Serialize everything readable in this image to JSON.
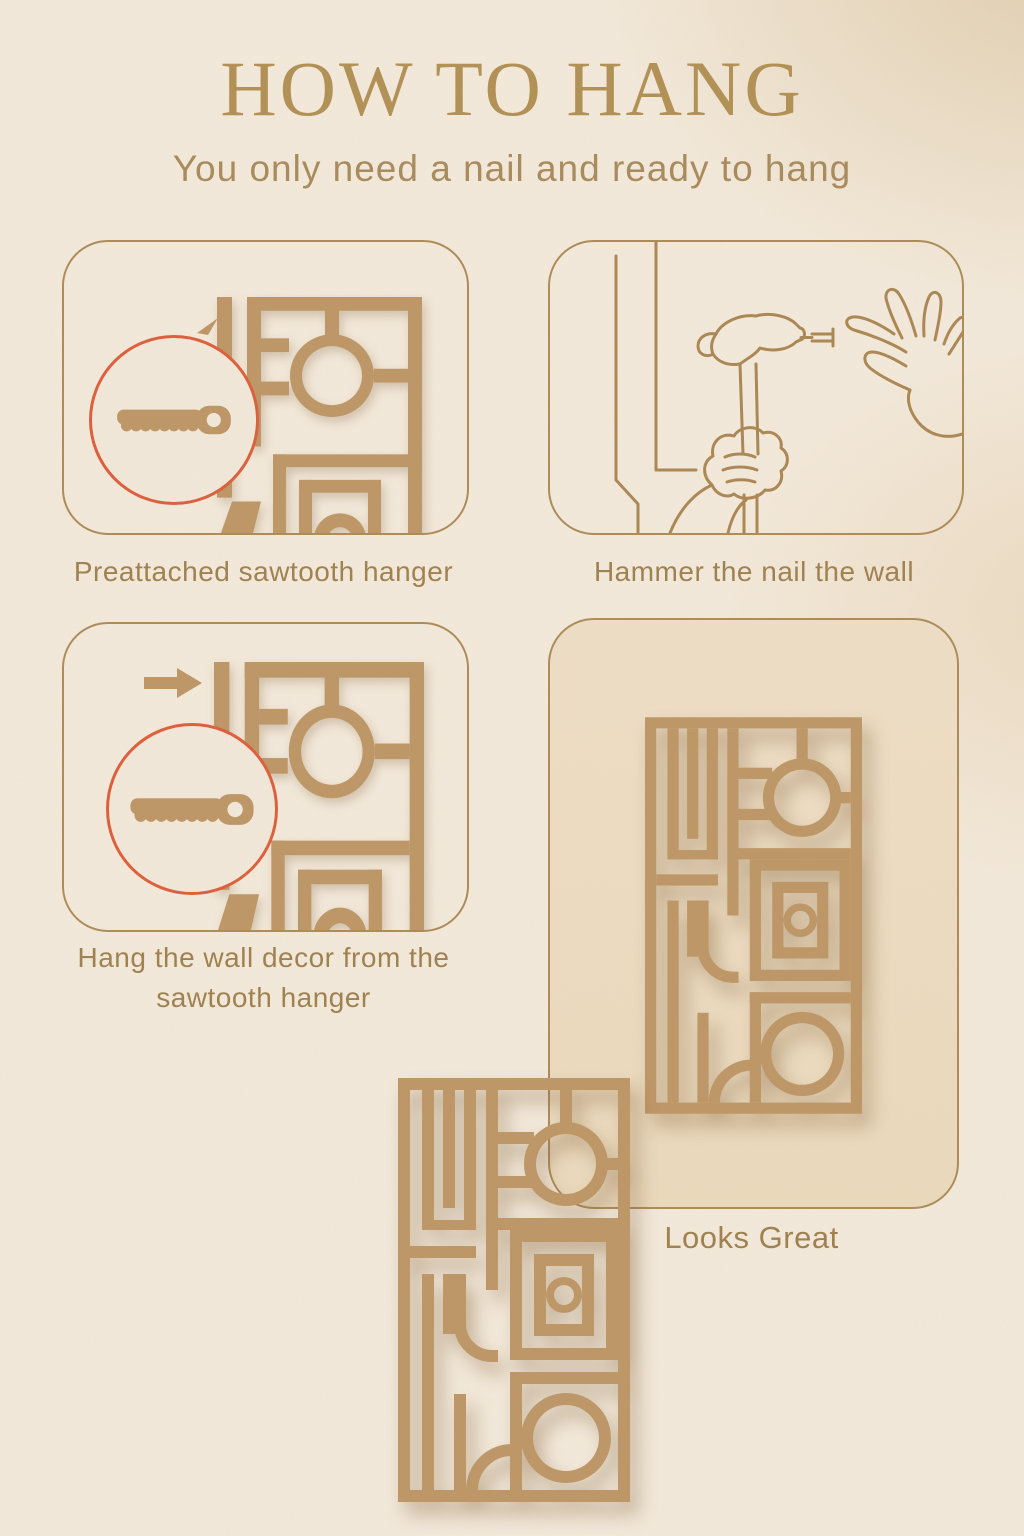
{
  "page": {
    "title": "HOW TO HANG",
    "subtitle": "You only need a nail and ready to hang"
  },
  "steps": [
    {
      "caption": "Preattached sawtooth hanger"
    },
    {
      "caption": "Hammer the nail the wall"
    },
    {
      "caption": "Hang the wall decor from the sawtooth hanger"
    },
    {
      "caption": "Looks Great"
    }
  ],
  "icons": [
    "sawtooth-hanger-icon",
    "arrow-right-icon",
    "hammer-and-nail-hands-icon",
    "wall-decor-pattern"
  ],
  "colors": {
    "background": "#f3e9da",
    "tan_pattern": "#bd9766",
    "line_art": "#ab8754",
    "panel_border": "#ad8b59",
    "title_text": "#b29156",
    "caption_text": "#9f8150",
    "accent_red": "#dd5f3c",
    "panel4_fill": "#eedec6"
  }
}
